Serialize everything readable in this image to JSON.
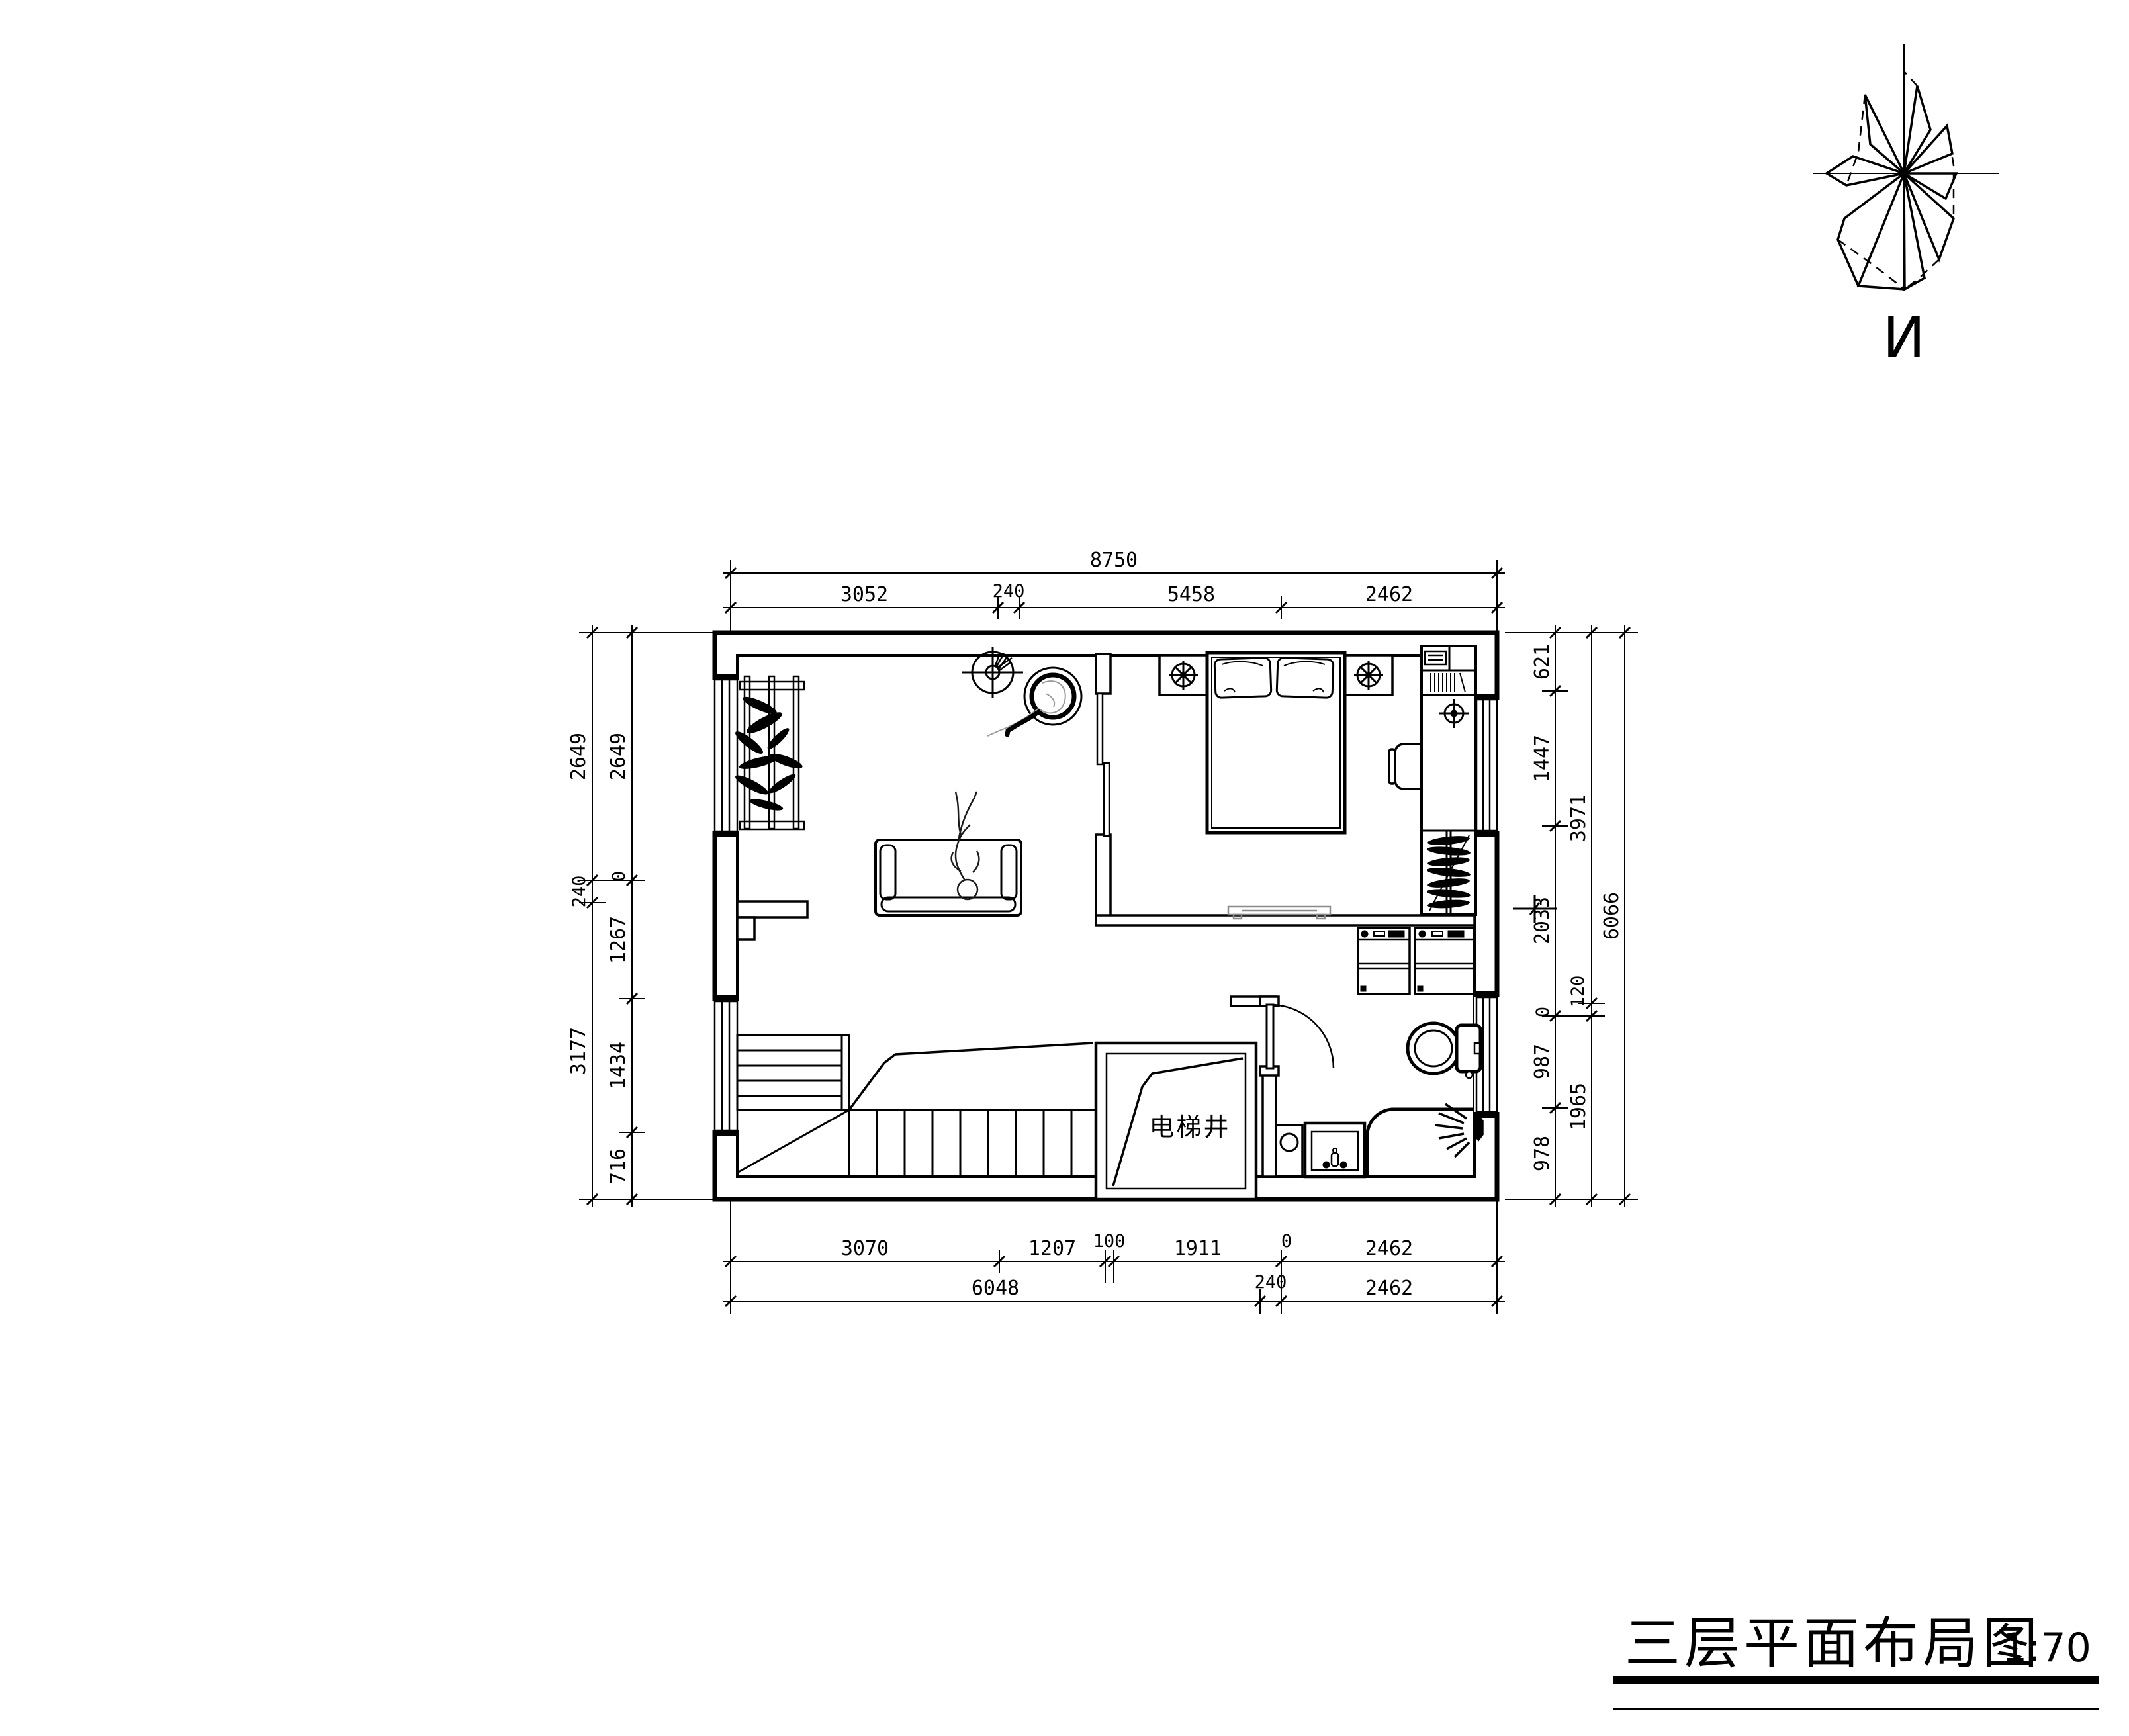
{
  "palette": {
    "ink": "#000000",
    "muted": "#8a8a8a",
    "background": "#ffffff"
  },
  "title_block": {
    "title": "三层平面布局图",
    "scale": "1:70"
  },
  "north_indicator": {
    "label": "N"
  },
  "plan": {
    "elevator_shaft_label": "电梯井"
  },
  "dimensions": {
    "top": {
      "overall": "8750",
      "segments": [
        "3052",
        "240",
        "5458",
        "2462"
      ]
    },
    "bottom": {
      "inner": [
        "3070",
        "1207",
        "100",
        "1911",
        "0",
        "2462"
      ],
      "outer": [
        "6048",
        "240",
        "2462"
      ]
    },
    "left": {
      "outer": [
        "2649",
        "240",
        "3177"
      ],
      "inner": [
        "2649",
        "0",
        "1267",
        "1434",
        "716"
      ]
    },
    "right": {
      "inner": [
        "621",
        "1447",
        "2033",
        "0",
        "987",
        "978"
      ],
      "middle": [
        "3971",
        "120",
        "1965"
      ],
      "overall": "6066"
    }
  }
}
